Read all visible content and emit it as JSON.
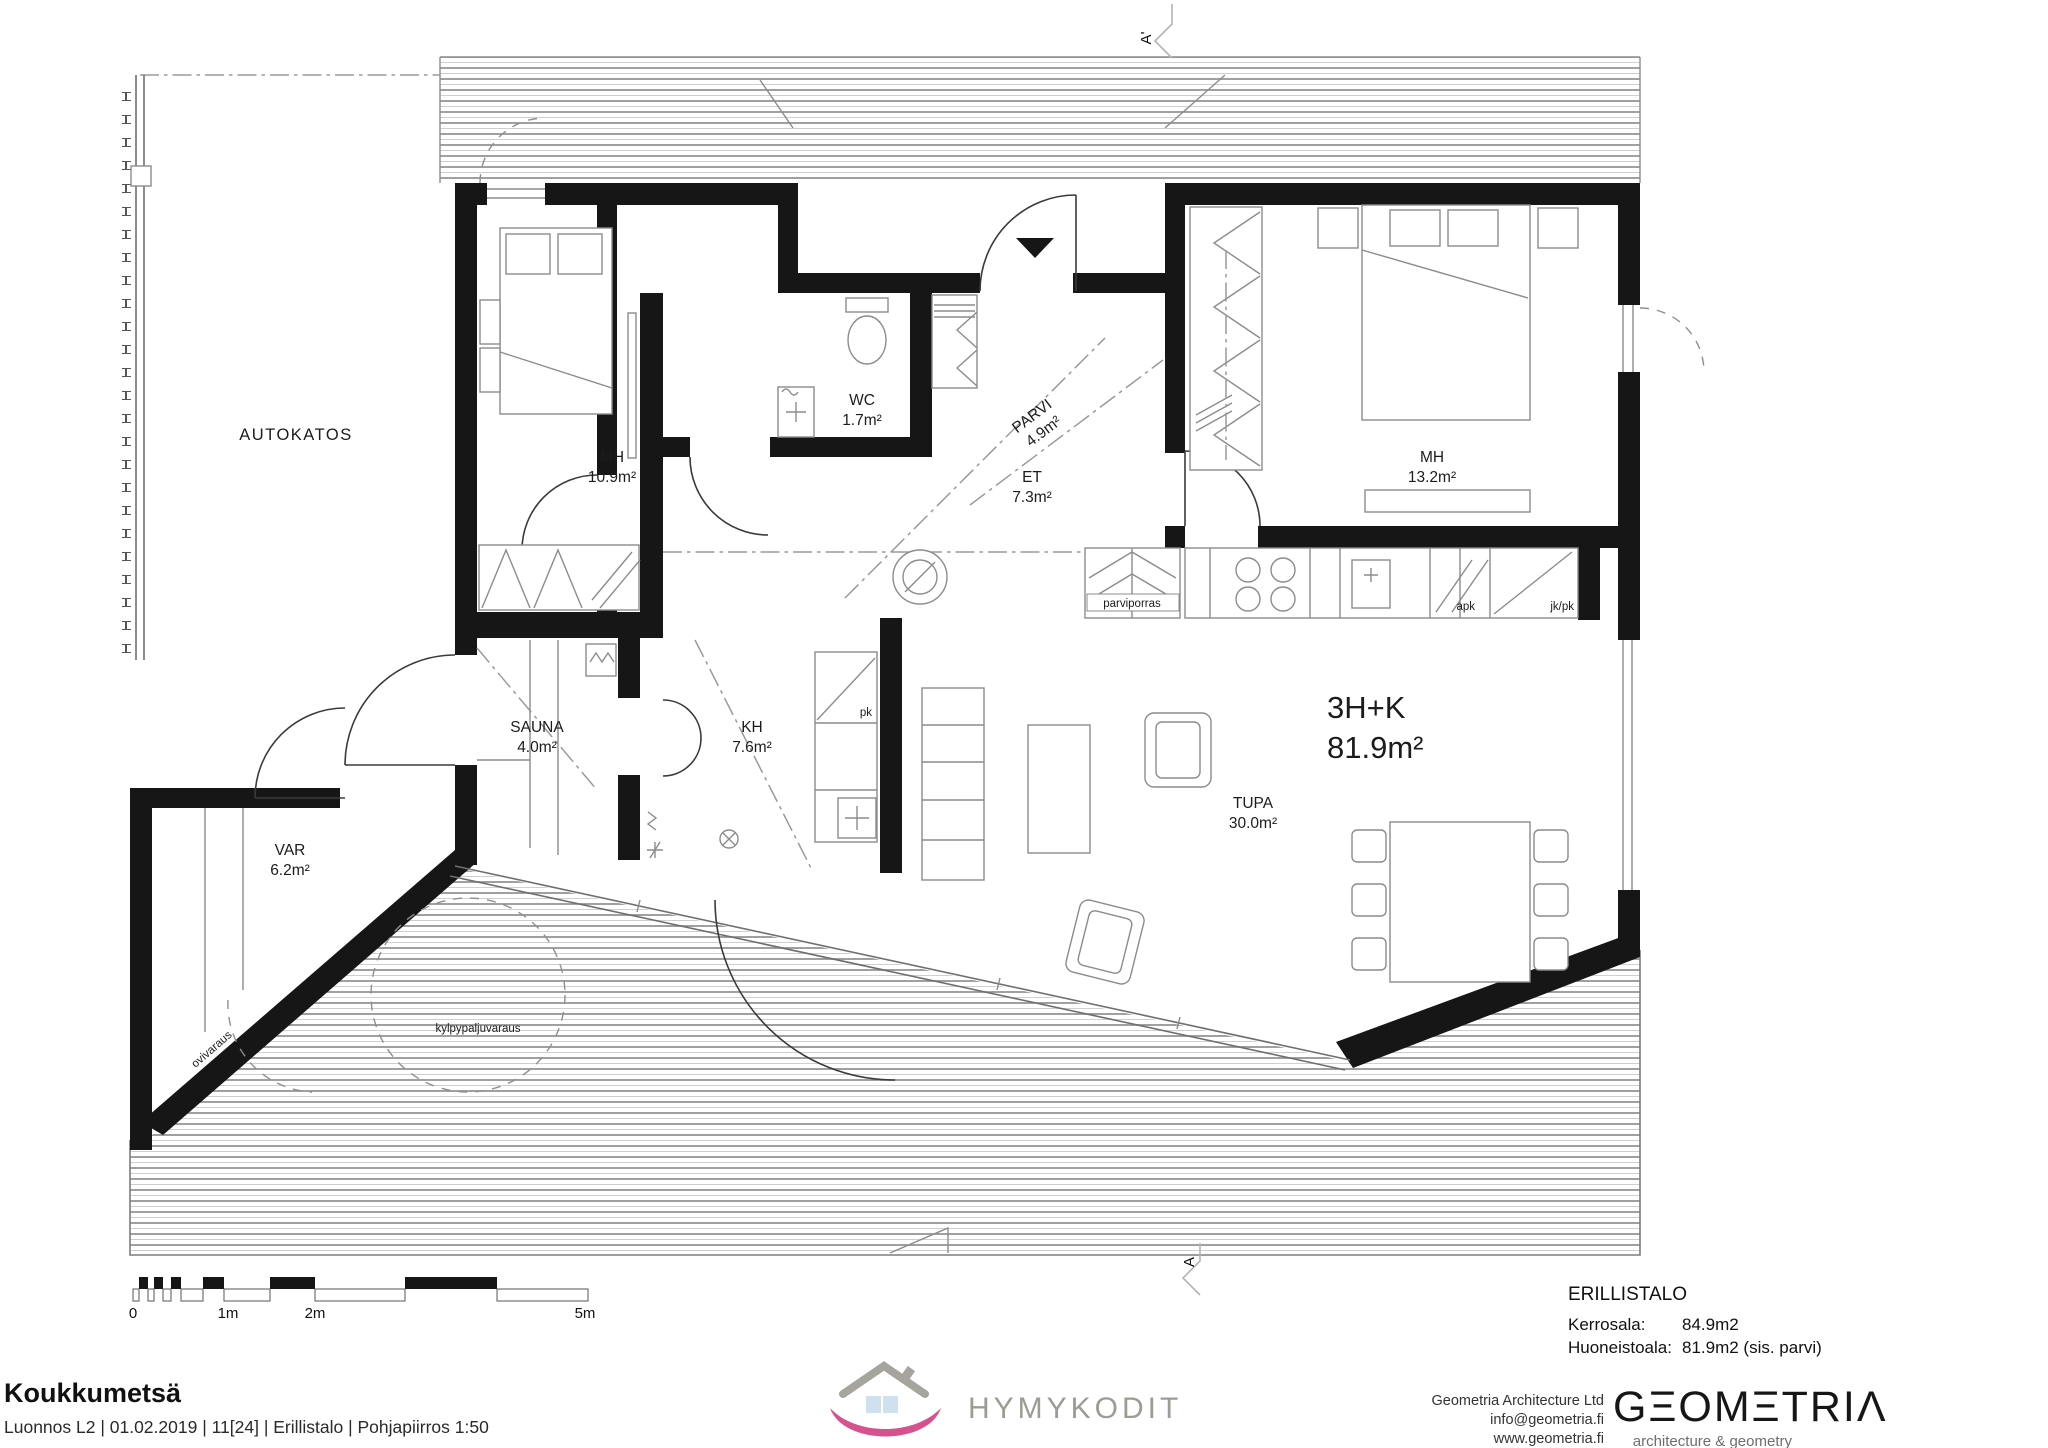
{
  "rooms": {
    "autokatos": {
      "label": "AUTOKATOS"
    },
    "mh1": {
      "label": "MH",
      "area": "10.9m²"
    },
    "wc": {
      "label": "WC",
      "area": "1.7m²"
    },
    "parvi": {
      "label": "PARVI",
      "area": "4.9m²"
    },
    "et": {
      "label": "ET",
      "area": "7.3m²"
    },
    "mh2": {
      "label": "MH",
      "area": "13.2m²"
    },
    "sauna": {
      "label": "SAUNA",
      "area": "4.0m²"
    },
    "kh": {
      "label": "KH",
      "area": "7.6m²"
    },
    "var": {
      "label": "VAR",
      "area": "6.2m²"
    },
    "tupa": {
      "label": "TUPA",
      "area": "30.0m²"
    }
  },
  "unit": {
    "type": "3H+K",
    "area": "81.9m²"
  },
  "annotations": {
    "parviporras": "parviporras",
    "apk": "apk",
    "jk_pk": "jk/pk",
    "pk": "pk",
    "ovivaraus": "ovivaraus",
    "kylpypaljuvaraus": "kylpypaljuvaraus"
  },
  "section": {
    "top": "A'",
    "bottom": "A"
  },
  "scalebar": {
    "m0": "0",
    "m1": "1m",
    "m2": "2m",
    "m5": "5m"
  },
  "titleblock": {
    "project": "Koukkumetsä",
    "details": "Luonnos L2  | 01.02.2019 | 11[24] | Erillistalo | Pohjapiirros 1:50"
  },
  "summary": {
    "building_type": "ERILLISTALO",
    "kerrosala_label": "Kerrosala:",
    "kerrosala_value": "84.9m2",
    "huoneistoala_label": "Huoneistoala:",
    "huoneistoala_value": "81.9m2 (sis. parvi)"
  },
  "architect": {
    "name": "Geometria Architecture Ltd",
    "email": "info@geometria.fi",
    "website": "www.geometria.fi",
    "logo": "GΞOMΞTRIΛ",
    "tagline": "architecture & geometry"
  },
  "brand": {
    "name": "HYMYKODIT"
  }
}
